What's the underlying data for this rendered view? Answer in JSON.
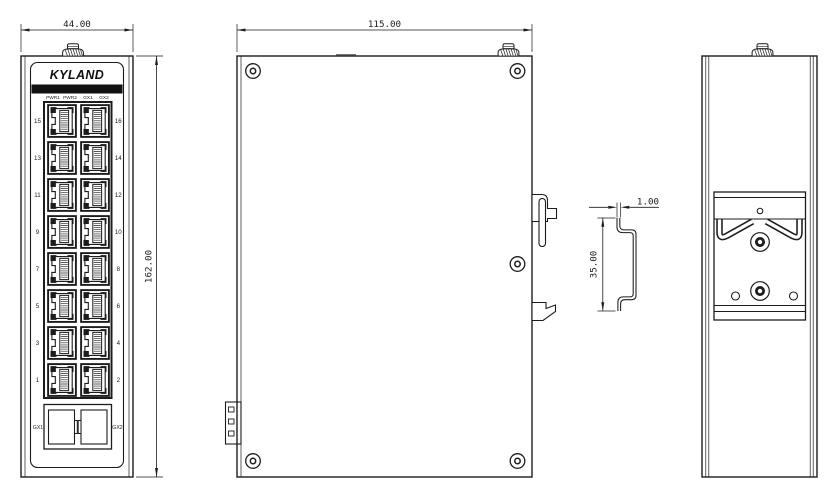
{
  "brand_logo": "KYLAND",
  "front": {
    "width_dim": "44.00",
    "height_dim": "162.00",
    "led_labels": [
      "PWR1",
      "PWR2",
      "GX1",
      "GX2"
    ],
    "ports_left": [
      "15",
      "13",
      "11",
      "9",
      "7",
      "5",
      "3",
      "1"
    ],
    "ports_right": [
      "16",
      "14",
      "12",
      "10",
      "8",
      "6",
      "4",
      "2"
    ],
    "sfp_labels": [
      "GX1",
      "GX2"
    ]
  },
  "side": {
    "width_dim": "115.00"
  },
  "din_rail": {
    "thickness_dim": "1.00",
    "height_dim": "35.00"
  },
  "colors": {
    "line": "#1c1c1c",
    "background": "#ffffff",
    "panel_bar": "#111111"
  }
}
